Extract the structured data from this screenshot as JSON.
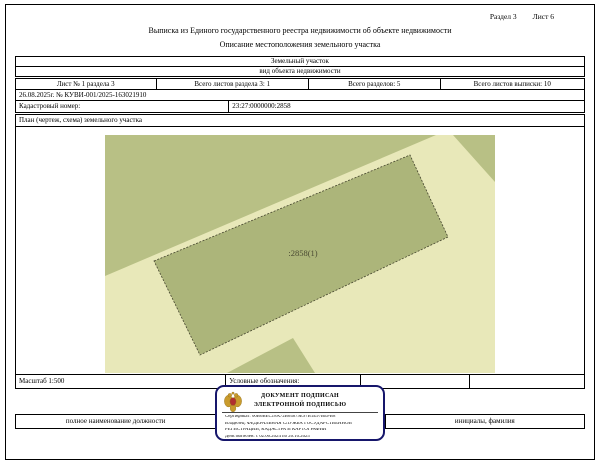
{
  "page": {
    "section_label": "Раздел 3",
    "sheet_label": "Лист 6",
    "title": "Выписка из Единого государственного реестра недвижимости об объекте недвижимости",
    "subtitle": "Описание местоположения земельного участка"
  },
  "object_table": {
    "object_type": "Земельный участок",
    "object_type_caption": "вид объекта недвижимости",
    "sheet_info": [
      "Лист № 1 раздела 3",
      "Всего листов раздела 3: 1",
      "Всего разделов: 5",
      "Всего листов выписки: 10"
    ],
    "statement_number": "26.08.2025г. № КУВИ-001/2025-163021910",
    "cadastral_number_label": "Кадастровый номер:",
    "cadastral_number": "23:27:0000000:2858"
  },
  "plan": {
    "header": "План (чертеж, схема) земельного участка",
    "scale_label": "Масштаб 1:500",
    "legend_label": "Условные обозначения:",
    "map": {
      "background": "#e8e8b9",
      "region_fill": "#b8c085",
      "regions": [
        "0,0 331,0 0,141",
        "348,0 390,0 390,47",
        "122,238 188,203 210,238"
      ],
      "parcel": {
        "points": "49,126 305,20 343,102 95,220",
        "fill": "#acb57a",
        "outline": "#45452e",
        "label": ":2858(1)",
        "label_x": 198,
        "label_y": 121,
        "label_color": "#4a4a33"
      }
    }
  },
  "signature_row": {
    "position_label": "полное наименование должности",
    "name_label": "инициалы, фамилия"
  },
  "stamp": {
    "border_color": "#16166b",
    "line1": "ДОКУМЕНТ ПОДПИСАН",
    "line2": "ЭЛЕКТРОННОЙ ПОДПИСЬЮ",
    "certificate": "Сертификат: 00В6ВЕС18А72В64879Е97В1Е97ВЕРВ8",
    "owner_line1": "Владелец: ФЕДЕРАЛЬНАЯ СЛУЖБА ГОСУДАРСТВЕННОЙ",
    "owner_line2": "РЕГИСТРАЦИИ, КАДАСТРА И КАРТОГРАФИИ",
    "validity": "Действителен: с 02.06.2024 по 26.10.2025"
  }
}
